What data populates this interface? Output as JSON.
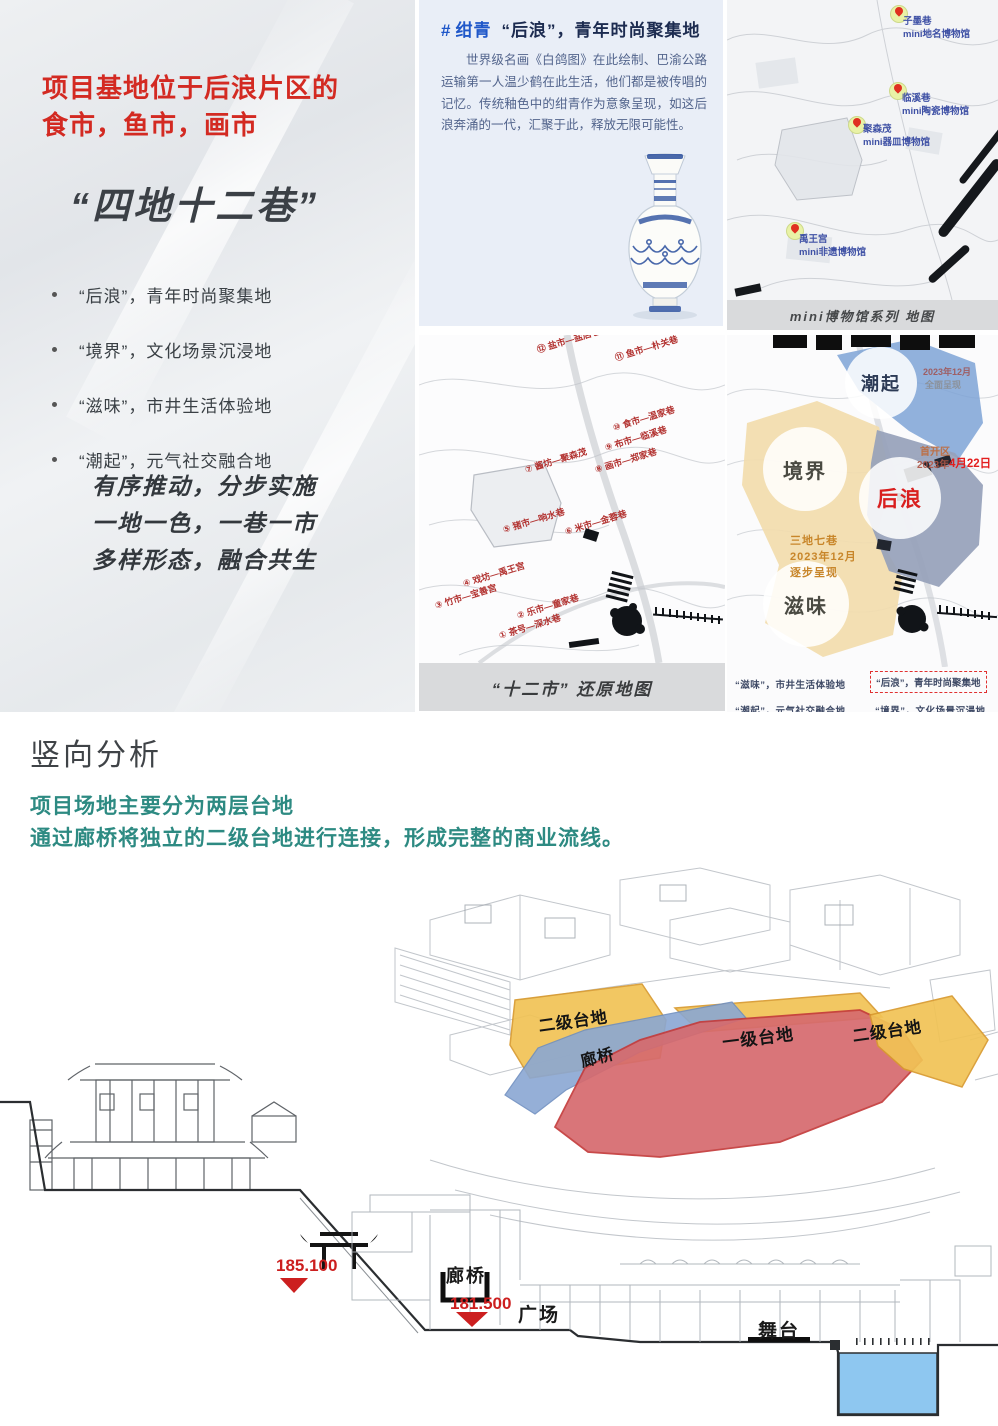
{
  "left_panel": {
    "title_line1": "项目基地位于后浪片区的",
    "title_line2": "食市，鱼市，画市",
    "slogan": "“四地十二巷”",
    "bullets": [
      "“后浪”，青年时尚聚集地",
      "“境界”，文化场景沉浸地",
      "“滋味”，市井生活体验地",
      "“潮起”，元气社交融合地"
    ],
    "motto_lines": [
      "有序推动，分步实施",
      "一地一色，一巷一市",
      "多样形态，融合共生"
    ]
  },
  "ganqing_panel": {
    "hash_mark": "#",
    "keyword": "绀青",
    "title_rest": "“后浪”，青年时尚聚集地",
    "paragraph": "世界级名画《白鸽图》在此绘制、巴渝公路运输第一人温少鹤在此生活，他们都是被传唱的记忆。传统釉色中的绀青作为意象呈现，如这后浪奔涌的一代，汇聚于此，释放无限可能性。"
  },
  "museum_map": {
    "caption": "mini博物馆系列 地图",
    "pins": [
      {
        "name": "子墨巷",
        "museum": "mini地名博物馆"
      },
      {
        "name": "临溪巷",
        "museum": "mini陶瓷博物馆"
      },
      {
        "name": "聚森茂",
        "museum": "mini器皿博物馆"
      },
      {
        "name": "禹王宫",
        "museum": "mini非遗博物馆"
      }
    ]
  },
  "twelve_market_map": {
    "caption": "“十二市” 还原地图",
    "labels": [
      "⑫ 盐市—盐店巷",
      "⑪ 鱼市—朴关巷",
      "⑩ 食市—温家巷",
      "⑨ 布市—临溪巷",
      "⑧ 画市—郑家巷",
      "⑦ 酱坊—聚森茂",
      "⑥ 米市—金蓉巷",
      "⑤ 猪市—响水巷",
      "④ 戏坊—禹王宫",
      "③ 竹市—宝善宫",
      "② 乐市—童家巷",
      "① 茶号—深水巷"
    ]
  },
  "zones_map": {
    "zone_chaoqi": "潮起",
    "zone_jingjie": "境界",
    "zone_houlang": "后浪",
    "zone_ziwei": "滋味",
    "chaoqi_note_line1": "2023年12月",
    "chaoqi_note_line2": "全面呈现",
    "houlang_note_line1": "首开区",
    "houlang_note_line2": "2023年",
    "houlang_date": "4月22日",
    "sandi_note_lines": [
      "三地七巷",
      "2023年12月",
      "逐步呈现"
    ],
    "legend": [
      "“滋味”，市井生活体验地",
      "“后浪”，青年时尚聚集地",
      "“潮起”，元气社交融合地",
      "“境界”，文化场景沉浸地"
    ]
  },
  "vertical_analysis": {
    "section_title": "竖向分析",
    "desc_line1": "项目场地主要分为两层台地",
    "desc_line2": "通过廊桥将独立的二级台地进行连接，形成完整的商业流线。",
    "axon_labels": {
      "terrace2_left": "二级台地",
      "langqiao": "廊桥",
      "terrace1": "一级台地",
      "terrace2_right": "二级台地"
    },
    "section_drawing": {
      "elev_upper": "185.100",
      "elev_lower": "181.500",
      "langqiao": "廊桥",
      "plaza": "广场",
      "stage": "舞台"
    }
  },
  "colors": {
    "accent_red": "#d32a22",
    "accent_blue": "#1f57c9",
    "teal_green": "#2d8a82",
    "terrace_yellow": "#f1c355",
    "terrace_red": "#d66a6e",
    "bridge_blue": "#8aa7d3",
    "water_blue": "#8ec7f0"
  }
}
